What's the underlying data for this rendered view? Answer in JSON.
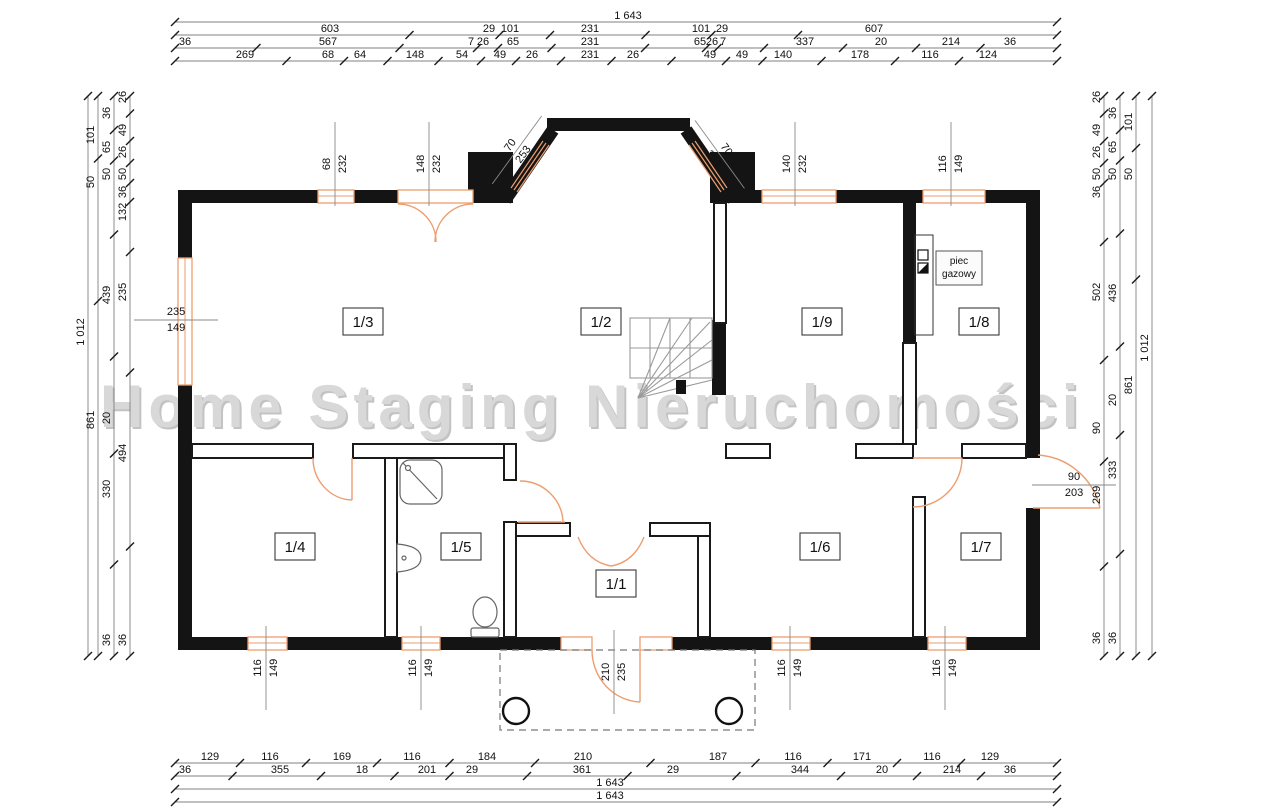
{
  "watermark": "Home Staging Nieruchomości",
  "colors": {
    "wall": "#141414",
    "opening_orange": "#ED9D6F",
    "watermark_gray": "#D8D8D8"
  },
  "furnace": {
    "line1": "piec",
    "line2": "gazowy"
  },
  "rooms": [
    {
      "id": "1/3",
      "x": 363,
      "y": 322
    },
    {
      "id": "1/2",
      "x": 601,
      "y": 322
    },
    {
      "id": "1/9",
      "x": 822,
      "y": 322
    },
    {
      "id": "1/8",
      "x": 979,
      "y": 322
    },
    {
      "id": "1/4",
      "x": 295,
      "y": 547
    },
    {
      "id": "1/5",
      "x": 461,
      "y": 547
    },
    {
      "id": "1/1",
      "x": 616,
      "y": 584
    },
    {
      "id": "1/6",
      "x": 820,
      "y": 547
    },
    {
      "id": "1/7",
      "x": 981,
      "y": 547
    }
  ],
  "dims": {
    "top": [
      {
        "y": 22,
        "x1": 175,
        "x2": 1057,
        "labels": [
          {
            "v": "1 643",
            "x": 628
          }
        ]
      },
      {
        "y": 35,
        "x1": 175,
        "x2": 1057,
        "labels": [
          {
            "v": "603",
            "x": 330
          },
          {
            "v": "29",
            "x": 489
          },
          {
            "v": "101",
            "x": 510
          },
          {
            "v": "231",
            "x": 590
          },
          {
            "v": "101",
            "x": 701
          },
          {
            "v": "29",
            "x": 722
          },
          {
            "v": "607",
            "x": 874
          }
        ]
      },
      {
        "y": 48,
        "x1": 175,
        "x2": 1057,
        "labels": [
          {
            "v": "36",
            "x": 185
          },
          {
            "v": "567",
            "x": 328
          },
          {
            "v": "7",
            "x": 471
          },
          {
            "v": "26",
            "x": 483
          },
          {
            "v": "65",
            "x": 513
          },
          {
            "v": "231",
            "x": 590
          },
          {
            "v": "65",
            "x": 700
          },
          {
            "v": "26",
            "x": 712
          },
          {
            "v": "7",
            "x": 723
          },
          {
            "v": "337",
            "x": 805
          },
          {
            "v": "20",
            "x": 881
          },
          {
            "v": "214",
            "x": 951
          },
          {
            "v": "36",
            "x": 1010
          }
        ]
      },
      {
        "y": 61,
        "x1": 175,
        "x2": 1057,
        "labels": [
          {
            "v": "269",
            "x": 245
          },
          {
            "v": "68",
            "x": 328
          },
          {
            "v": "64",
            "x": 360
          },
          {
            "v": "148",
            "x": 415
          },
          {
            "v": "54",
            "x": 462
          },
          {
            "v": "49",
            "x": 500
          },
          {
            "v": "26",
            "x": 532
          },
          {
            "v": "231",
            "x": 590
          },
          {
            "v": "26",
            "x": 633
          },
          {
            "v": "49",
            "x": 710
          },
          {
            "v": "49",
            "x": 742
          },
          {
            "v": "140",
            "x": 783
          },
          {
            "v": "178",
            "x": 860
          },
          {
            "v": "116",
            "x": 930
          },
          {
            "v": "124",
            "x": 988
          }
        ]
      }
    ],
    "bottom": [
      {
        "y": 763,
        "x1": 175,
        "x2": 1057,
        "labels": [
          {
            "v": "129",
            "x": 210
          },
          {
            "v": "116",
            "x": 270
          },
          {
            "v": "169",
            "x": 342
          },
          {
            "v": "116",
            "x": 412
          },
          {
            "v": "184",
            "x": 487
          },
          {
            "v": "210",
            "x": 583
          },
          {
            "v": "187",
            "x": 718
          },
          {
            "v": "116",
            "x": 793
          },
          {
            "v": "171",
            "x": 862
          },
          {
            "v": "116",
            "x": 932
          },
          {
            "v": "129",
            "x": 990
          }
        ]
      },
      {
        "y": 776,
        "x1": 175,
        "x2": 1057,
        "labels": [
          {
            "v": "36",
            "x": 185
          },
          {
            "v": "355",
            "x": 280
          },
          {
            "v": "18",
            "x": 362
          },
          {
            "v": "201",
            "x": 427
          },
          {
            "v": "29",
            "x": 472
          },
          {
            "v": "361",
            "x": 582
          },
          {
            "v": "29",
            "x": 673
          },
          {
            "v": "344",
            "x": 800
          },
          {
            "v": "20",
            "x": 882
          },
          {
            "v": "214",
            "x": 952
          },
          {
            "v": "36",
            "x": 1010
          }
        ]
      },
      {
        "y": 789,
        "x1": 175,
        "x2": 1057,
        "labels": [
          {
            "v": "1 643",
            "x": 610
          }
        ]
      },
      {
        "y": 802,
        "x1": 175,
        "x2": 1057,
        "labels": [
          {
            "v": "1 643",
            "x": 610
          }
        ]
      }
    ],
    "left": [
      {
        "x": 88,
        "y1": 96,
        "y2": 656,
        "labels": [
          {
            "v": "1 012",
            "y": 332
          }
        ]
      },
      {
        "x": 98,
        "y1": 96,
        "y2": 656,
        "labels": [
          {
            "v": "101",
            "y": 135
          },
          {
            "v": "50",
            "y": 182
          },
          {
            "v": "861",
            "y": 420
          }
        ]
      },
      {
        "x": 114,
        "y1": 96,
        "y2": 656,
        "labels": [
          {
            "v": "36",
            "y": 113
          },
          {
            "v": "65",
            "y": 147
          },
          {
            "v": "50",
            "y": 174
          },
          {
            "v": "439",
            "y": 295
          },
          {
            "v": "20",
            "y": 418
          },
          {
            "v": "330",
            "y": 489
          },
          {
            "v": "36",
            "y": 640
          }
        ]
      },
      {
        "x": 130,
        "y1": 96,
        "y2": 656,
        "labels": [
          {
            "v": "26",
            "y": 97
          },
          {
            "v": "49",
            "y": 130
          },
          {
            "v": "26",
            "y": 152
          },
          {
            "v": "50",
            "y": 174
          },
          {
            "v": "36",
            "y": 192
          },
          {
            "v": "132",
            "y": 212
          },
          {
            "v": "235",
            "y": 292
          },
          {
            "v": "494",
            "y": 453
          },
          {
            "v": "36",
            "y": 640
          }
        ]
      }
    ],
    "right": [
      {
        "x": 1104,
        "y1": 96,
        "y2": 656,
        "labels": [
          {
            "v": "26",
            "y": 97
          },
          {
            "v": "49",
            "y": 130
          },
          {
            "v": "26",
            "y": 152
          },
          {
            "v": "50",
            "y": 174
          },
          {
            "v": "36",
            "y": 192
          },
          {
            "v": "502",
            "y": 292
          },
          {
            "v": "90",
            "y": 428
          },
          {
            "v": "269",
            "y": 495
          },
          {
            "v": "36",
            "y": 638
          }
        ]
      },
      {
        "x": 1120,
        "y1": 96,
        "y2": 656,
        "labels": [
          {
            "v": "36",
            "y": 113
          },
          {
            "v": "65",
            "y": 147
          },
          {
            "v": "50",
            "y": 174
          },
          {
            "v": "436",
            "y": 293
          },
          {
            "v": "20",
            "y": 400
          },
          {
            "v": "333",
            "y": 470
          },
          {
            "v": "36",
            "y": 638
          }
        ]
      },
      {
        "x": 1136,
        "y1": 96,
        "y2": 656,
        "labels": [
          {
            "v": "101",
            "y": 122
          },
          {
            "v": "50",
            "y": 174
          },
          {
            "v": "861",
            "y": 385
          }
        ]
      },
      {
        "x": 1152,
        "y1": 96,
        "y2": 656,
        "labels": [
          {
            "v": "1 012",
            "y": 348
          }
        ]
      }
    ]
  },
  "openings": [
    {
      "a": "68",
      "b": "232",
      "x": 333,
      "y": 168,
      "rot": -90
    },
    {
      "a": "148",
      "b": "232",
      "x": 427,
      "y": 168,
      "rot": -90
    },
    {
      "a": "70",
      "b": "253",
      "x": 513,
      "y": 152,
      "rot": -54
    },
    {
      "a": "70",
      "b": "253",
      "x": 719,
      "y": 150,
      "rot": 54
    },
    {
      "a": "140",
      "b": "232",
      "x": 793,
      "y": 168,
      "rot": -90
    },
    {
      "a": "116",
      "b": "149",
      "x": 949,
      "y": 168,
      "rot": -90
    },
    {
      "a": "235",
      "b": "149",
      "x": 172,
      "y": 318,
      "rot": 0
    },
    {
      "a": "90",
      "b": "203",
      "x": 1070,
      "y": 483,
      "rot": 0
    },
    {
      "a": "116",
      "b": "149",
      "x": 264,
      "y": 672,
      "rot": -90
    },
    {
      "a": "116",
      "b": "149",
      "x": 419,
      "y": 672,
      "rot": -90
    },
    {
      "a": "210",
      "b": "235",
      "x": 612,
      "y": 676,
      "rot": -90
    },
    {
      "a": "116",
      "b": "149",
      "x": 788,
      "y": 672,
      "rot": -90
    },
    {
      "a": "116",
      "b": "149",
      "x": 943,
      "y": 672,
      "rot": -90
    }
  ]
}
